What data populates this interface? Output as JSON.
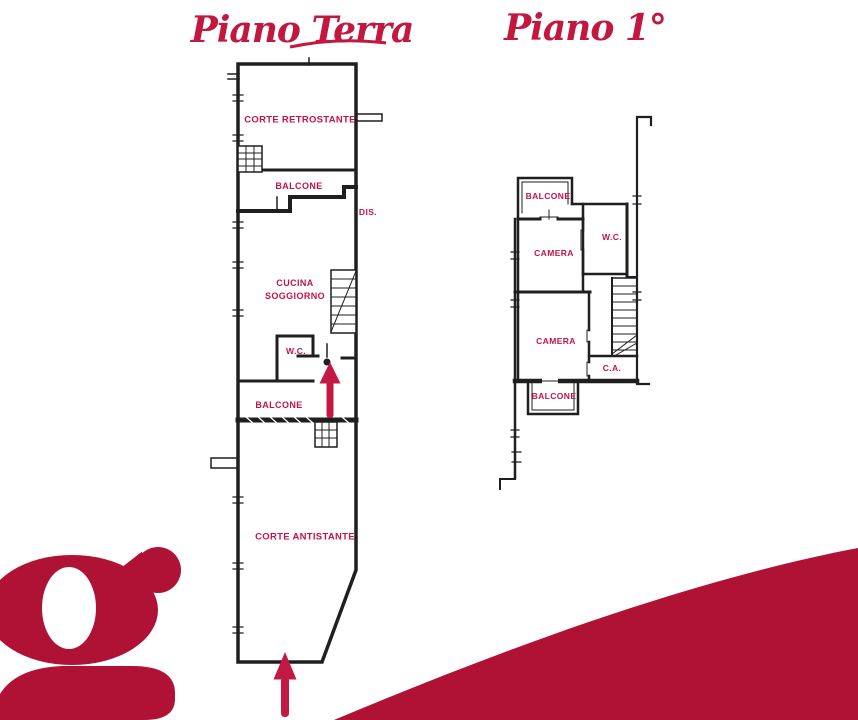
{
  "colors": {
    "accent_red_text": "#C2173F",
    "room_label_red": "#C4134A",
    "arrow_red": "#C41845",
    "brand_shape_red": "#AF1235",
    "line_black": "#1f1f1e",
    "background": "#ffffff"
  },
  "titles": {
    "ground_floor": "Piano Terra",
    "first_floor": "Piano 1°"
  },
  "ground_floor": {
    "labels": {
      "corte_retrostante": "CORTE RETROSTANTE",
      "balcone_nord": "BALCONE",
      "dis": "DIS.",
      "cucina_line1": "CUCINA",
      "cucina_line2": "SOGGIORNO",
      "wc": "W.C.",
      "balcone_sud": "BALCONE",
      "corte_antistante": "CORTE ANTISTANTE"
    }
  },
  "first_floor": {
    "labels": {
      "balcone_nord": "BALCONE",
      "wc": "W.C.",
      "camera_nord": "CAMERA",
      "camera_sud": "CAMERA",
      "ca": "C.A.",
      "balcone_sud": "BALCONE"
    }
  },
  "branding": {
    "logo_letter": "g"
  }
}
